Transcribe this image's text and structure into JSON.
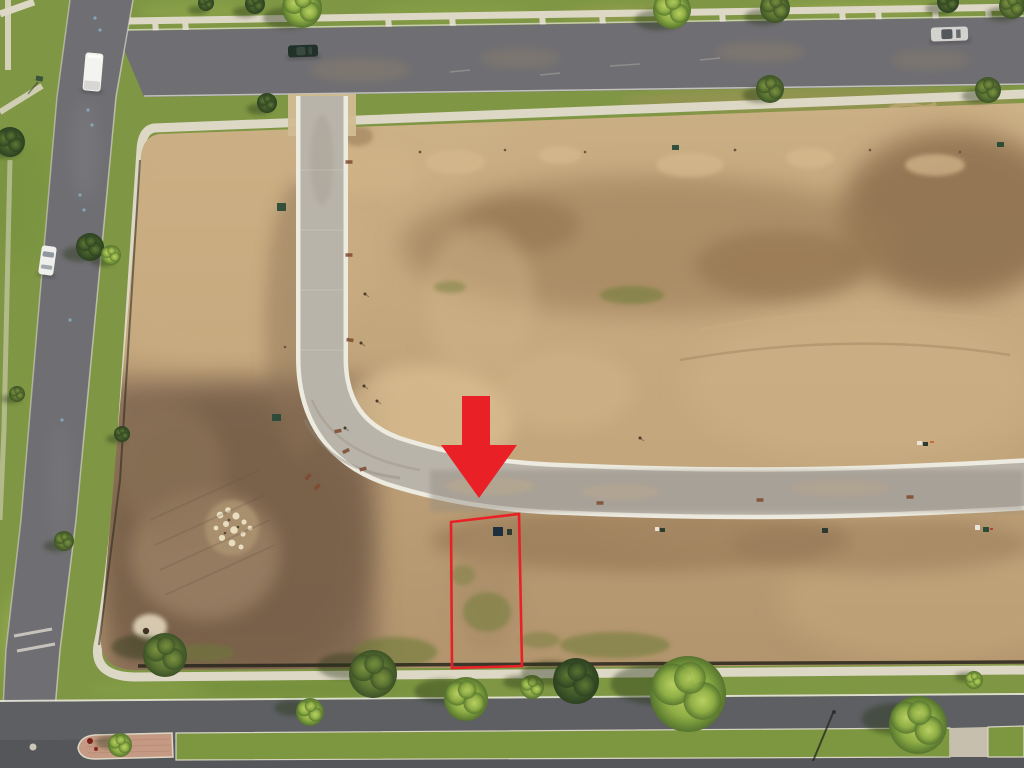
{
  "meta": {
    "type": "aerial-drone-photograph",
    "description": "Aerial view of a graded residential development: vacant dirt lots bounded by streets, with a new curved concrete road, a red arrow pointing to a vacant lot outlined in red for sale, surrounding grass parkways, sidewalks, trees and parked cars.",
    "width": 1024,
    "height": 768
  },
  "colors": {
    "grass-base": "#7f9744",
    "grass-light": "#a5b155",
    "grass-dark": "#5f7c36",
    "sidewalk": "#ddd7c5",
    "asphalt": "#6f6e72",
    "asphalt-dark": "#5d5f63",
    "asphalt-deep": "#54565a",
    "road-concrete": "#b9b4aa",
    "road-casing": "#edeae0",
    "dirt-base": "#bfa279",
    "dirt-dark": "#7b6450",
    "sand": "#d9bd90",
    "fence": "#27251c",
    "brick": "#c59a84",
    "curb-white": "#e7e4da",
    "red": "#e92127"
  },
  "scene": {
    "highlight": {
      "arrow_points": "462,396 490,396 490,445 517,445 479,498 441,445 462,445",
      "lot_outline_points": "451,522 519,514 522,666 452,668"
    },
    "walk_connectors": [
      155,
      185,
      388,
      452,
      542,
      602,
      662,
      722,
      782,
      842,
      878,
      935,
      988
    ],
    "trees": [
      {
        "x": 302,
        "y": 8,
        "r": 20,
        "tone": "light",
        "sx": -14,
        "sy": 10
      },
      {
        "x": 255,
        "y": 4,
        "r": 10,
        "tone": "dark",
        "sx": -10,
        "sy": 8
      },
      {
        "x": 206,
        "y": 3,
        "r": 8,
        "tone": "dark",
        "sx": -8,
        "sy": 7
      },
      {
        "x": 672,
        "y": 10,
        "r": 19,
        "tone": "light",
        "sx": -14,
        "sy": 10
      },
      {
        "x": 775,
        "y": 8,
        "r": 15,
        "tone": "olive",
        "sx": -12,
        "sy": 9
      },
      {
        "x": 948,
        "y": 2,
        "r": 11,
        "tone": "dark",
        "sx": -9,
        "sy": 7
      },
      {
        "x": 1012,
        "y": 6,
        "r": 13,
        "tone": "olive",
        "sx": -10,
        "sy": 8
      },
      {
        "x": 267,
        "y": 103,
        "r": 10,
        "tone": "dark",
        "sx": -8,
        "sy": 6
      },
      {
        "x": 770,
        "y": 89,
        "r": 14,
        "tone": "olive",
        "sx": -10,
        "sy": 6
      },
      {
        "x": 988,
        "y": 90,
        "r": 13,
        "tone": "olive",
        "sx": -10,
        "sy": 6
      },
      {
        "x": 10,
        "y": 142,
        "r": 15,
        "tone": "dark",
        "sx": -8,
        "sy": 8
      },
      {
        "x": 90,
        "y": 247,
        "r": 14,
        "tone": "dark",
        "sx": -10,
        "sy": 7
      },
      {
        "x": 111,
        "y": 255,
        "r": 10,
        "tone": "light",
        "sx": -8,
        "sy": 6
      },
      {
        "x": 64,
        "y": 541,
        "r": 10,
        "tone": "olive",
        "sx": -8,
        "sy": 5
      },
      {
        "x": 17,
        "y": 394,
        "r": 8,
        "tone": "olive",
        "sx": -6,
        "sy": 5
      },
      {
        "x": 122,
        "y": 434,
        "r": 8,
        "tone": "dark",
        "sx": -6,
        "sy": 5
      },
      {
        "x": 165,
        "y": 655,
        "r": 22,
        "tone": "olive",
        "sx": -26,
        "sy": -8
      },
      {
        "x": 310,
        "y": 712,
        "r": 14,
        "tone": "light",
        "sx": -18,
        "sy": -4
      },
      {
        "x": 373,
        "y": 674,
        "r": 24,
        "tone": "olive",
        "sx": -26,
        "sy": -8
      },
      {
        "x": 466,
        "y": 699,
        "r": 22,
        "tone": "light",
        "sx": -24,
        "sy": -8
      },
      {
        "x": 532,
        "y": 687,
        "r": 12,
        "tone": "light",
        "sx": -14,
        "sy": -5
      },
      {
        "x": 576,
        "y": 681,
        "r": 23,
        "tone": "dark",
        "sx": -26,
        "sy": -8
      },
      {
        "x": 688,
        "y": 694,
        "r": 38,
        "tone": "light",
        "sx": -30,
        "sy": -10
      },
      {
        "x": 918,
        "y": 725,
        "r": 29,
        "tone": "light",
        "sx": -20,
        "sy": -6
      },
      {
        "x": 974,
        "y": 680,
        "r": 9,
        "tone": "light",
        "sx": -8,
        "sy": -3
      },
      {
        "x": 120,
        "y": 745,
        "r": 12,
        "tone": "light",
        "sx": -10,
        "sy": -3
      }
    ],
    "cars": [
      {
        "name": "white-box-truck",
        "x": 84,
        "y": 53,
        "w": 18,
        "h": 38,
        "rot": 5,
        "body": "#f3f3ef",
        "glass": "#d8d7d3",
        "cab": true
      },
      {
        "name": "white-sedan",
        "x": 40,
        "y": 246,
        "w": 15,
        "h": 29,
        "rot": 8,
        "body": "#efefec",
        "glass": "#8f979c",
        "cab": false
      },
      {
        "name": "dark-green-car",
        "x": 288,
        "y": 45,
        "w": 30,
        "h": 12,
        "rot": -2,
        "body": "#22302a",
        "glass": "#39493f",
        "cab": false
      },
      {
        "name": "silver-car",
        "x": 931,
        "y": 27,
        "w": 37,
        "h": 14,
        "rot": -2,
        "body": "#d3d2ce",
        "glass": "#53575b",
        "cab": false
      }
    ],
    "utility_boxes": [
      {
        "x": 272,
        "y": 414,
        "w": 9,
        "h": 7,
        "c": "#2e4a38"
      },
      {
        "x": 277,
        "y": 203,
        "w": 9,
        "h": 8,
        "c": "#33503c"
      },
      {
        "x": 672,
        "y": 145,
        "w": 7,
        "h": 5,
        "c": "#33503c"
      },
      {
        "x": 997,
        "y": 142,
        "w": 7,
        "h": 5,
        "c": "#2e4a38"
      },
      {
        "x": 917,
        "y": 441,
        "w": 5,
        "h": 4,
        "c": "#e8e4da"
      },
      {
        "x": 923,
        "y": 442,
        "w": 5,
        "h": 4,
        "c": "#2c3a30"
      },
      {
        "x": 930,
        "y": 441,
        "w": 4,
        "h": 2,
        "c": "#c96a3a"
      },
      {
        "x": 822,
        "y": 528,
        "w": 6,
        "h": 5,
        "c": "#2c3a30"
      },
      {
        "x": 655,
        "y": 527,
        "w": 4,
        "h": 4,
        "c": "#e8e4da"
      },
      {
        "x": 660,
        "y": 528,
        "w": 5,
        "h": 4,
        "c": "#2c3a30"
      },
      {
        "x": 975,
        "y": 525,
        "w": 5,
        "h": 5,
        "c": "#e8e4da"
      },
      {
        "x": 983,
        "y": 527,
        "w": 6,
        "h": 5,
        "c": "#2e4a38"
      },
      {
        "x": 990,
        "y": 528,
        "w": 3,
        "h": 2,
        "c": "#b5402c"
      },
      {
        "x": 493,
        "y": 527,
        "w": 10,
        "h": 9,
        "c": "#1e2f3e"
      },
      {
        "x": 507,
        "y": 529,
        "w": 5,
        "h": 6,
        "c": "#2c3a30"
      }
    ],
    "curb_markers": [
      {
        "x": 349,
        "y": 162,
        "rot": 0
      },
      {
        "x": 349,
        "y": 255,
        "rot": 0
      },
      {
        "x": 350,
        "y": 340,
        "rot": 8
      },
      {
        "x": 338,
        "y": 431,
        "rot": -10
      },
      {
        "x": 346,
        "y": 451,
        "rot": -25
      },
      {
        "x": 363,
        "y": 469,
        "rot": -15
      },
      {
        "x": 308,
        "y": 477,
        "rot": -50
      },
      {
        "x": 317,
        "y": 487,
        "rot": -40
      },
      {
        "x": 600,
        "y": 503,
        "rot": 0
      },
      {
        "x": 760,
        "y": 500,
        "rot": 0
      },
      {
        "x": 910,
        "y": 497,
        "rot": 0
      }
    ],
    "stakes": [
      [
        365,
        294
      ],
      [
        361,
        343
      ],
      [
        364,
        386
      ],
      [
        377,
        401
      ],
      [
        345,
        428
      ],
      [
        640,
        438
      ]
    ],
    "blue_paint_marks": [
      [
        95,
        18
      ],
      [
        100,
        30
      ],
      [
        88,
        110
      ],
      [
        92,
        125
      ],
      [
        80,
        195
      ],
      [
        84,
        210
      ],
      [
        70,
        320
      ],
      [
        62,
        420
      ]
    ]
  }
}
